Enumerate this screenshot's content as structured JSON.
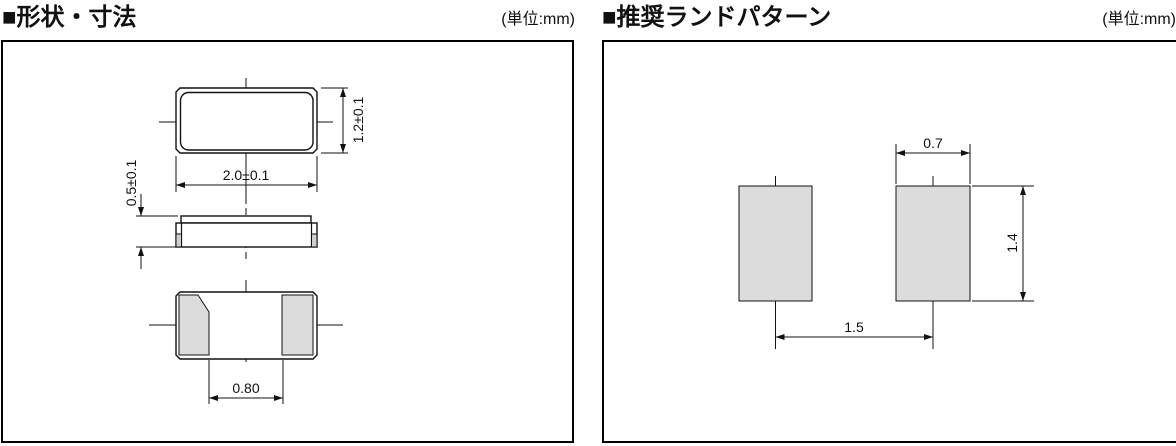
{
  "panels": {
    "dimensions": {
      "marker": "■",
      "title": "形状・寸法",
      "unit": "(単位:mm)",
      "dims": {
        "body_width": "2.0±0.1",
        "body_height": "1.2±0.1",
        "body_thickness": "0.5±0.1",
        "electrode_gap": "0.80"
      }
    },
    "land_pattern": {
      "marker": "■",
      "title": "推奨ランドパターン",
      "unit": "(単位:mm)",
      "dims": {
        "pad_width": "0.7",
        "pad_height": "1.4",
        "pad_pitch": "1.5"
      }
    }
  },
  "colors": {
    "line": "#111111",
    "panel_border": "#000000",
    "land_pad_fill": "#dcdcdc",
    "bottom_pad_fill": "#dcdcdc",
    "side_pad_fill": "#cfcfcf",
    "background": "#ffffff"
  }
}
